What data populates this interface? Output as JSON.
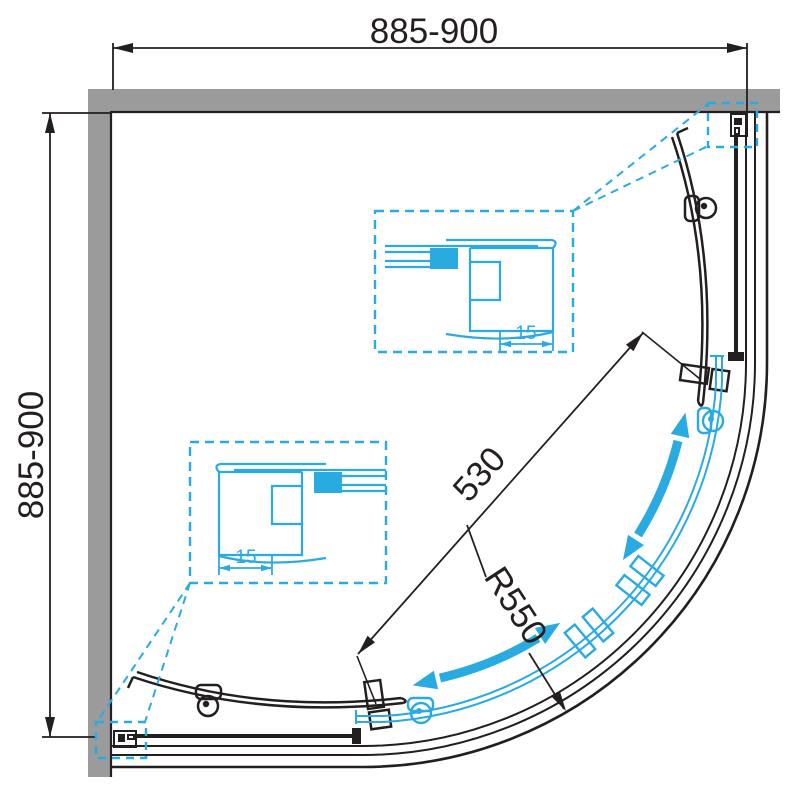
{
  "diagram": {
    "kind": "quadrant-shower-enclosure-plan",
    "dimensions": {
      "top_width": "885-900",
      "left_height": "885-900",
      "door_opening": "530",
      "radius": "R550",
      "profile_adjust_top": "15",
      "profile_adjust_bottom": "15"
    },
    "colors": {
      "accent_cyan": "#29abe2",
      "wall_gray": "#9b9b9b",
      "line_black": "#231f20"
    }
  }
}
